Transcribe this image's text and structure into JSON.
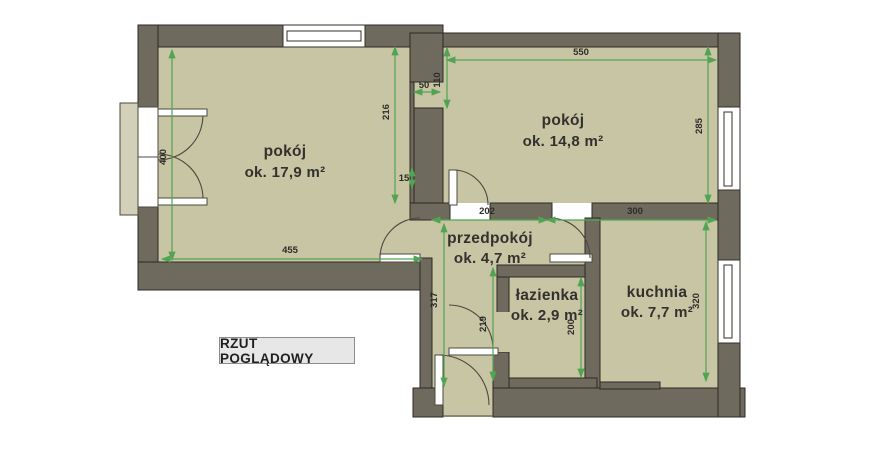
{
  "title": "RZUT POGLĄDOWY",
  "colors": {
    "wall": "#6f6a5e",
    "floor": "#c7c5a4",
    "balcony_slab": "#d3d0ba",
    "dimension_green": "#52a352",
    "outline": "#2e2a24",
    "window": "#ffffff",
    "door_arc": "#4d493f",
    "title_box_bg": "#e7e7e7",
    "title_box_border": "#8d8d8d",
    "text": "#2d2c28"
  },
  "rooms": [
    {
      "name": "pokój",
      "area": "ok. 17,9 m²"
    },
    {
      "name": "pokój",
      "area": "ok. 14,8 m²"
    },
    {
      "name": "przedpokój",
      "area": "ok. 4,7 m²"
    },
    {
      "name": "łazienka",
      "area": "ok. 2,9 m²"
    },
    {
      "name": "kuchnia",
      "area": "ok. 7,7 m²"
    }
  ],
  "dimensions": {
    "d550": "550",
    "d110": "110",
    "d50": "50",
    "d216": "216",
    "d285": "285",
    "d400": "400",
    "d455": "455",
    "d202": "202",
    "d300": "300",
    "d317": "317",
    "d219": "219",
    "d200": "200",
    "d320": "320",
    "d15": "15"
  }
}
